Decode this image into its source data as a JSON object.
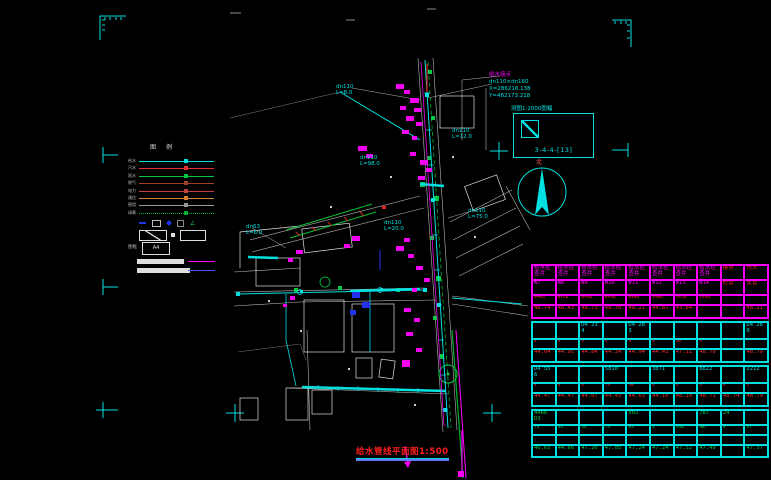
{
  "drawing": {
    "title": "给水管线平面图1:500",
    "map_sheet_note": "测图1:2000图幅",
    "sheet_index": "3-4-4-[13]",
    "north_label": "北",
    "connection_note": {
      "name": "给水接点",
      "size": "dn110×dn160",
      "x": "X=286216.138",
      "y": "Y=482173.218"
    },
    "pipe_labels": [
      {
        "text": "dn110",
        "sub": "L=8.0",
        "x": 336,
        "y": 84
      },
      {
        "text": "dn110",
        "sub": "L=98.0",
        "x": 360,
        "y": 155
      },
      {
        "text": "dn110",
        "sub": "L=75.0",
        "x": 468,
        "y": 208
      },
      {
        "text": "dn110",
        "sub": "L=20.0",
        "x": 384,
        "y": 220
      },
      {
        "text": "dn63",
        "sub": "L=6.0",
        "x": 246,
        "y": 224
      },
      {
        "text": "dn110",
        "sub": "L=12.0",
        "x": 452,
        "y": 128
      }
    ]
  },
  "legend": {
    "title": "图例",
    "rows": [
      {
        "label": "给水",
        "color": "#00e0e0",
        "style": "solid"
      },
      {
        "label": "污水",
        "color": "#e03030",
        "style": "solid"
      },
      {
        "label": "雨水",
        "color": "#00c840",
        "style": "solid"
      },
      {
        "label": "燃气",
        "color": "#a04228",
        "style": "solid"
      },
      {
        "label": "电力",
        "color": "#c04040",
        "style": "solid"
      },
      {
        "label": "通信",
        "color": "#d08030",
        "style": "solid"
      },
      {
        "label": "围墙",
        "color": "#9a9a9a",
        "style": "solid"
      },
      {
        "label": "绿篱",
        "color": "#00b030",
        "style": "dotted"
      }
    ],
    "frame_label": "图框",
    "frame_size": "A4"
  },
  "table": {
    "sections": [
      {
        "border": "#ff00ff",
        "rowHeights": [
          13,
          13,
          8,
          11
        ],
        "rows": [
          {
            "color": "#ff00ff",
            "redTail": true,
            "cells": [
              "给水检查井",
              "给水检查井",
              "给水检查井",
              "给水检查井",
              "给水检查井",
              "给水检查井",
              "给水检查井",
              "给水检查井",
              "接点",
              "甩头"
            ]
          },
          {
            "color": "#ff00ff",
            "redTail": true,
            "cells": [
              "W7",
              "W8",
              "W9",
              "W10",
              "W11",
              "W12",
              "W13",
              "W14",
              "砼管",
              "支管"
            ]
          },
          {
            "color": "#ff2a2a",
            "cells": [
              "0+06",
              "0+26",
              "0+46",
              "0+66",
              "0+86",
              "1+06",
              "1+26",
              "1+46",
              "",
              ""
            ]
          },
          {
            "color": "#ff2a2a",
            "cells": [
              "48.74",
              "48.43",
              "48.73",
              "48.76",
              "48.21",
              "44.87",
              "43.84",
              "",
              "",
              "48.21"
            ]
          }
        ]
      },
      {
        "border": "#00e0e0",
        "rowHeights": [
          15,
          8,
          11
        ],
        "rows": [
          {
            "color": "#00e0e0",
            "cells": [
              "",
              "",
              "D4 234",
              "",
              "D4 283",
              "",
              "",
              "",
              "",
              "D4 280"
            ]
          },
          {
            "color": "#ff2a2a",
            "cells": [
              "4",
              "4",
              "4",
              "4",
              "4",
              "4",
              "40",
              "4",
              "",
              ""
            ]
          },
          {
            "color": "#ff2a2a",
            "cells": [
              "44.04",
              "44.95",
              "44.84",
              "44.34",
              "44.94",
              "44.41",
              "47.11",
              "48.79",
              "",
              "48.79"
            ]
          }
        ]
      },
      {
        "border": "#00e0e0",
        "rowHeights": [
          15,
          8,
          11
        ],
        "rows": [
          {
            "color": "#00e0e0",
            "cells": [
              "D4 556",
              "",
              "",
              "5810",
              "",
              "3871",
              "",
              "8822",
              "",
              "2212"
            ]
          },
          {
            "color": "#ff2a2a",
            "cells": [
              "4",
              "4",
              "4",
              "74",
              "40",
              "4",
              "4",
              "4",
              "4",
              "4"
            ]
          },
          {
            "color": "#ff2a2a",
            "cells": [
              "44.47",
              "44.47",
              "44.07",
              "44.43",
              "44.63",
              "44.10",
              "48.10",
              "48.71",
              "48.74",
              "48.79"
            ]
          }
        ]
      },
      {
        "border": "#00e0e0",
        "rowHeights": [
          13,
          8,
          8,
          10
        ],
        "rows": [
          {
            "color": "#00cc44",
            "cells": [
              "4466 D3",
              "",
              "",
              "",
              "502",
              "",
              "",
              "787",
              "24",
              ""
            ]
          },
          {
            "color": "#00cc44",
            "cells": [
              "79",
              "94",
              "49",
              "74",
              "69",
              "4",
              "390",
              "987",
              "9",
              "97"
            ]
          },
          {
            "color": "#00cc44",
            "cells": [
              "",
              "",
              "",
              "",
              "",
              "",
              "",
              "",
              "",
              ""
            ]
          },
          {
            "color": "#00cc44",
            "cells": [
              "46.65",
              "44.66",
              "47.26",
              "47.05",
              "47.24",
              "47.24",
              "47.52",
              "47.49",
              "",
              "47.57"
            ]
          }
        ]
      }
    ]
  }
}
